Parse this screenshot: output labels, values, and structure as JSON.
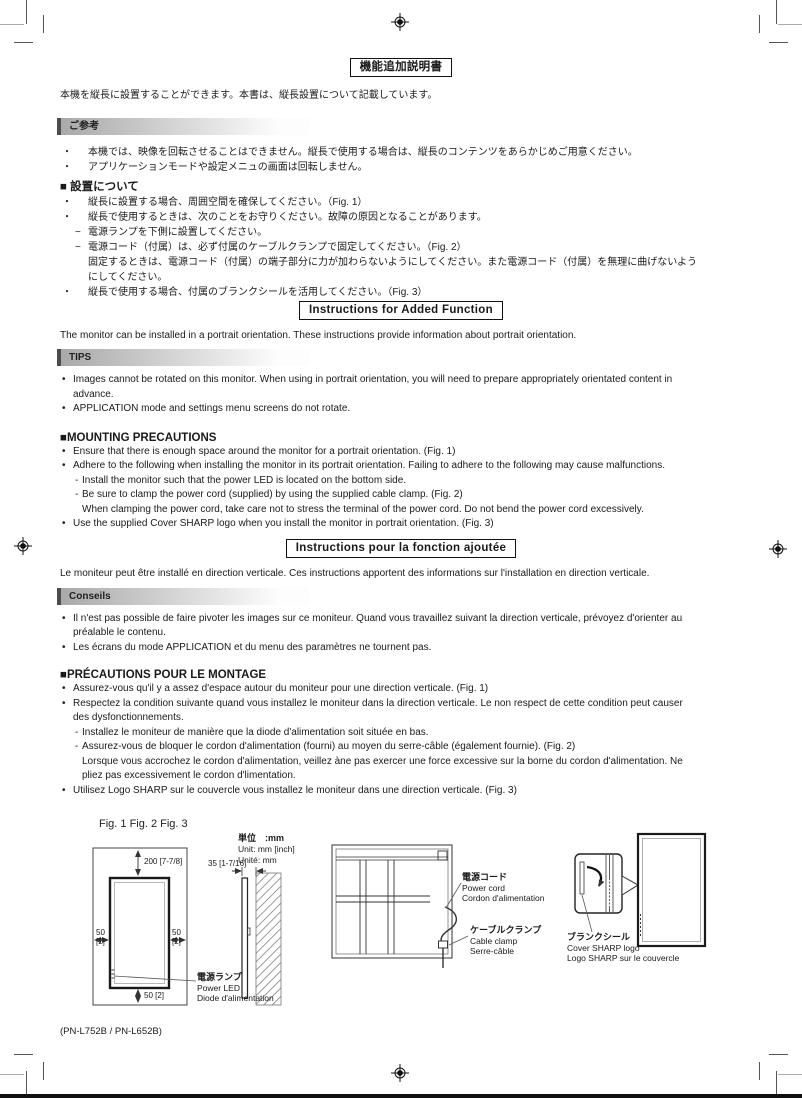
{
  "jp": {
    "box_title": "機能追加説明書",
    "intro": "本機を縦長に設置することができます。本書は、縦長設置について記載しています。",
    "note_header": "ご参考",
    "notes": [
      {
        "g": "・",
        "t": "本機では、映像を回転させることはできません。縦長で使用する場合は、縦長のコンテンツをあらかじめご用意ください。"
      },
      {
        "g": "・",
        "t": "アプリケーションモードや設定メニュの画面は回転しません。"
      }
    ],
    "heading": "■ 設置について",
    "items": [
      {
        "g": "・",
        "t": "縦長に設置する場合、周囲空間を確保してください。（Fig. 1）"
      },
      {
        "g": "・",
        "t": "縦長で使用するときは、次のことをお守りください。故障の原因となることがあります。"
      },
      {
        "g": "−",
        "t": "電源ランプを下側に設置してください。"
      },
      {
        "g": "−",
        "t": "電源コード（付属）は、必ず付属のケーブルクランプで固定してください。（Fig. 2）"
      },
      {
        "g": "",
        "t": "固定するときは、電源コード（付属）の端子部分に力が加わらないようにしてください。また電源コード（付属）を無理に曲げないよう"
      },
      {
        "g": "",
        "t": "にしてください。"
      },
      {
        "g": "・",
        "t": "縦長で使用する場合、付属のブランクシールを活用してください。（Fig. 3）"
      }
    ]
  },
  "en": {
    "box_title": "Instructions for Added Function",
    "intro": "The monitor can be installed in a portrait orientation. These instructions provide information about portrait orientation.",
    "note_header": "TIPS",
    "notes": [
      {
        "g": "•",
        "t": "Images cannot be rotated on this monitor. When using in portrait orientation, you will need to prepare appropriately orientated content in"
      },
      {
        "g": "",
        "t": "advance."
      },
      {
        "g": "•",
        "t": "APPLICATION mode and settings menu screens do not rotate."
      }
    ],
    "heading": "■MOUNTING PRECAUTIONS",
    "items": [
      {
        "g": "•",
        "t": "Ensure that there is enough space around the monitor for a portrait orientation. (Fig. 1)"
      },
      {
        "g": "•",
        "t": "Adhere to the following when installing the monitor in its portrait orientation. Failing to adhere to the following may cause malfunctions."
      },
      {
        "g": "-",
        "t": "Install the monitor such that the power LED is located on the bottom side."
      },
      {
        "g": "-",
        "t": "Be sure to clamp the power cord (supplied) by using the supplied cable clamp. (Fig. 2)"
      },
      {
        "g": "",
        "t": "When clamping the power cord, take care not to stress the terminal of the power cord. Do not bend the power cord excessively."
      },
      {
        "g": "•",
        "t": "Use the supplied Cover SHARP logo when you install the monitor in portrait orientation. (Fig. 3)"
      }
    ]
  },
  "fr": {
    "box_title": "Instructions pour la fonction ajoutée",
    "intro": "Le moniteur peut être installé en direction verticale. Ces instructions apportent des informations sur l'installation en direction verticale.",
    "note_header": "Conseils",
    "notes": [
      {
        "g": "•",
        "t": "Il n'est pas possible de faire pivoter les images sur ce moniteur. Quand vous travaillez suivant la direction verticale, prévoyez d'orienter au"
      },
      {
        "g": "",
        "t": "préalable le contenu."
      },
      {
        "g": "•",
        "t": "Les écrans du mode APPLICATION et du menu des paramètres ne tournent pas."
      }
    ],
    "heading": "■PRÉCAUTIONS POUR LE MONTAGE",
    "items": [
      {
        "g": "•",
        "t": "Assurez-vous qu'il y a assez d'espace autour du moniteur pour une direction verticale. (Fig. 1)"
      },
      {
        "g": "•",
        "t": "Respectez la condition suivante quand vous installez le moniteur dans la direction verticale. Le non respect de cette condition peut causer"
      },
      {
        "g": "",
        "t": "des dysfonctionnements."
      },
      {
        "g": "-",
        "t": "Installez le moniteur de manière que la diode d'alimentation soit située en bas."
      },
      {
        "g": "-",
        "t": "Assurez-vous de bloquer le cordon d'alimentation (fourni) au moyen du serre-câble (également fournie). (Fig. 2)"
      },
      {
        "g": "",
        "t": "Lorsque vous accrochez le cordon d'alimentation, veillez àne pas exercer une force excessive sur la borne du cordon d'alimentation. Ne"
      },
      {
        "g": "",
        "t": "pliez pas excessivement le cordon d'limentation."
      },
      {
        "g": "•",
        "t": "Utilisez Logo SHARP sur le couvercle vous installez le moniteur dans une direction verticale. (Fig. 3)"
      }
    ]
  },
  "figures": {
    "heading": "Fig. 1 Fig. 2 Fig. 3",
    "units": {
      "jp": "単位　:mm",
      "en": "Unit: mm [inch]",
      "fr": "Unité: mm"
    },
    "dims": {
      "top": "200 [7-7/8]",
      "left1": "50",
      "left2": "[2]",
      "right1": "50",
      "right2": "[2]",
      "bottom": "50 [2]",
      "depth": "35 [1-7/16]"
    },
    "power_led": {
      "jp": "電源ランプ",
      "en": "Power LED",
      "fr": "Diode d'alimentation"
    },
    "power_cord": {
      "jp": "電源コード",
      "en": "Power cord",
      "fr": "Cordon d'alimentation"
    },
    "cable_clamp": {
      "jp": "ケーブルクランプ",
      "en": "Cable clamp",
      "fr": "Serre-câble"
    },
    "cover_logo": {
      "jp": "ブランクシール",
      "en": "Cover SHARP logo",
      "fr": "Logo SHARP sur le couvercle"
    }
  },
  "footer": {
    "model": "(PN-L752B / PN-L652B)"
  },
  "colors": {
    "ink": "#1a1a1a",
    "bar_gradient_start": "#a9a9a9",
    "bar_accent": "#4c4c4c"
  }
}
